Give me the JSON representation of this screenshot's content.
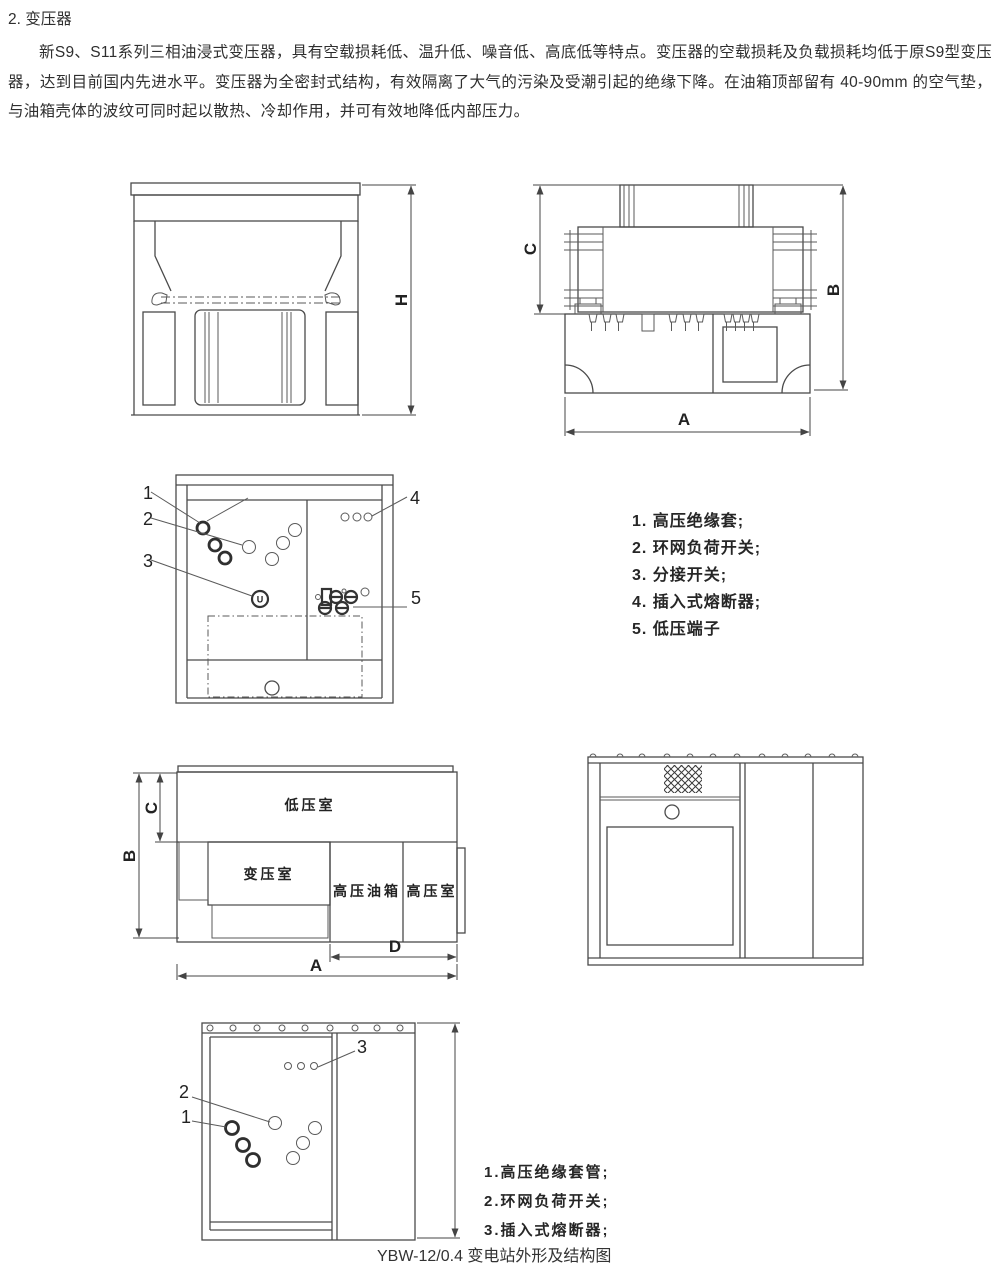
{
  "doc": {
    "section_title": "2. 变压器",
    "paragraph": "新S9、S11系列三相油浸式变压器，具有空载损耗低、温升低、噪音低、高底低等特点。变压器的空载损耗及负载损耗均低于原S9型变压器，达到目前国内先进水平。变压器为全密封式结构，有效隔离了大气的污染及受潮引起的绝缘下降。在油箱顶部留有 40-90mm 的空气垫，与油箱壳体的波纹可同时起以散热、冷却作用，并可有效地降低内部压力。",
    "caption": "YBW-12/0.4 变电站外形及结构图"
  },
  "figures": {
    "front_view": {
      "dim_h": "H"
    },
    "top_view": {
      "dim_a": "A",
      "dim_b": "B",
      "dim_c": "C"
    },
    "structure_view": {
      "callout_1": "1",
      "callout_2": "2",
      "callout_3": "3",
      "callout_4": "4",
      "callout_5": "5",
      "tap_switch_glyph": "U"
    },
    "plan_view": {
      "room_low_voltage": "低压室",
      "room_transformer": "变压室",
      "room_hv_oil_tank": "高压油箱",
      "room_hv": "高压室",
      "dim_a": "A",
      "dim_b": "B",
      "dim_c": "C",
      "dim_d": "D"
    },
    "station_view": {
      "callout_1": "1",
      "callout_2": "2",
      "callout_3": "3"
    }
  },
  "legend_transformer": {
    "item_1": "1. 高压绝缘套;",
    "item_2": "2. 环网负荷开关;",
    "item_3": "3. 分接开关;",
    "item_4": "4. 插入式熔断器;",
    "item_5": "5. 低压端子"
  },
  "legend_station": {
    "item_1": "1.高压绝缘套管;",
    "item_2": "2.环网负荷开关;",
    "item_3": "3.插入式熔断器;"
  },
  "colors": {
    "ink": "#2e2e2e",
    "line": "#4a4a4a",
    "background": "#ffffff"
  }
}
